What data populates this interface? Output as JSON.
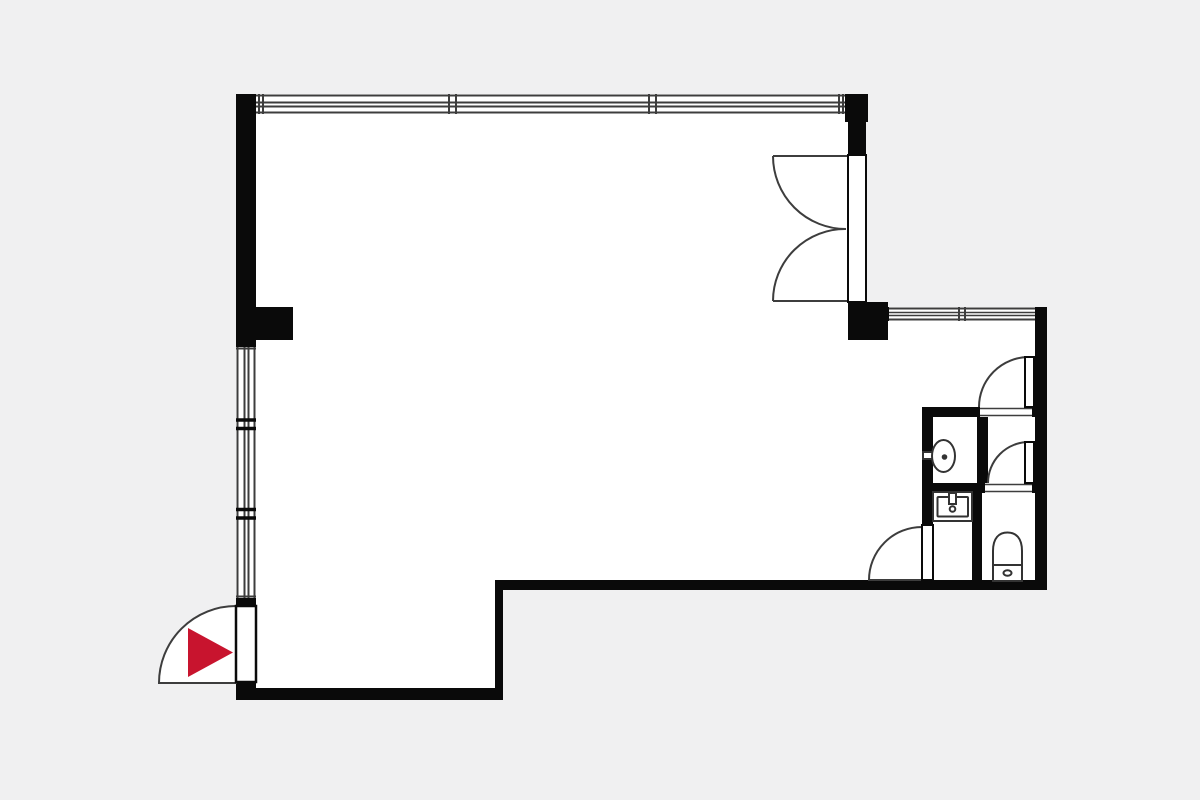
{
  "meta": {
    "label": "Apartment floor plan"
  },
  "colors": {
    "bg": "#f0f0f1",
    "floor": "#ffffff",
    "wall": "#0a0a0a",
    "line": "#3d3d3d",
    "fixture": "#333333",
    "accent": "#c8142e"
  },
  "symbols": {
    "entrance_marker": "red-arrow-right",
    "doors": [
      "entrance-door-swing-out",
      "balcony-double-door-swing-in",
      "bathroom-door-swing-out",
      "closet-door-swing-up",
      "wc-door-swing-up"
    ],
    "windows": [
      "top-window-three-sections",
      "left-window-three-sections",
      "right-wing-window-two-sections"
    ],
    "fixtures": [
      "wall-hung-washbasin",
      "vanity-sink",
      "toilet"
    ]
  }
}
